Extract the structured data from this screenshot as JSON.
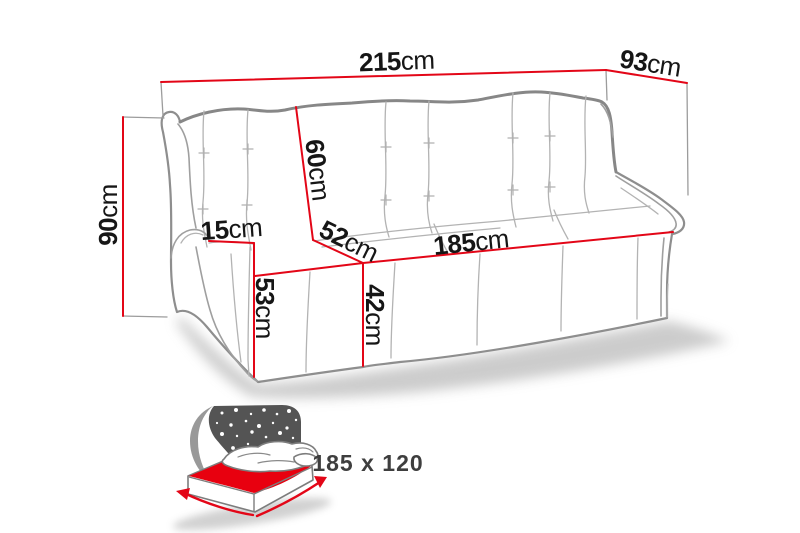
{
  "dims": {
    "overall_width": {
      "value": "215",
      "unit": "cm"
    },
    "overall_depth": {
      "value": "93",
      "unit": "cm"
    },
    "overall_height": {
      "value": "90",
      "unit": "cm"
    },
    "backrest_height": {
      "value": "60",
      "unit": "cm"
    },
    "armrest_width": {
      "value": "15",
      "unit": "cm"
    },
    "seat_depth": {
      "value": "52",
      "unit": "cm"
    },
    "seat_width": {
      "value": "185",
      "unit": "cm"
    },
    "armrest_height": {
      "value": "53",
      "unit": "cm"
    },
    "seat_height": {
      "value": "42",
      "unit": "cm"
    }
  },
  "sleeping_area": {
    "label": "185 x 120"
  },
  "colors": {
    "dimension_line_red": "#e30617",
    "label_text": "#161616",
    "sofa_outline_gray": "#8e8e8e",
    "seam_gray": "#b3b3b3",
    "night_panel_gray": "#545454",
    "bed_top_red": "#e8000f",
    "sleeping_area_text": "#3e3e3e",
    "background": "#ffffff"
  }
}
